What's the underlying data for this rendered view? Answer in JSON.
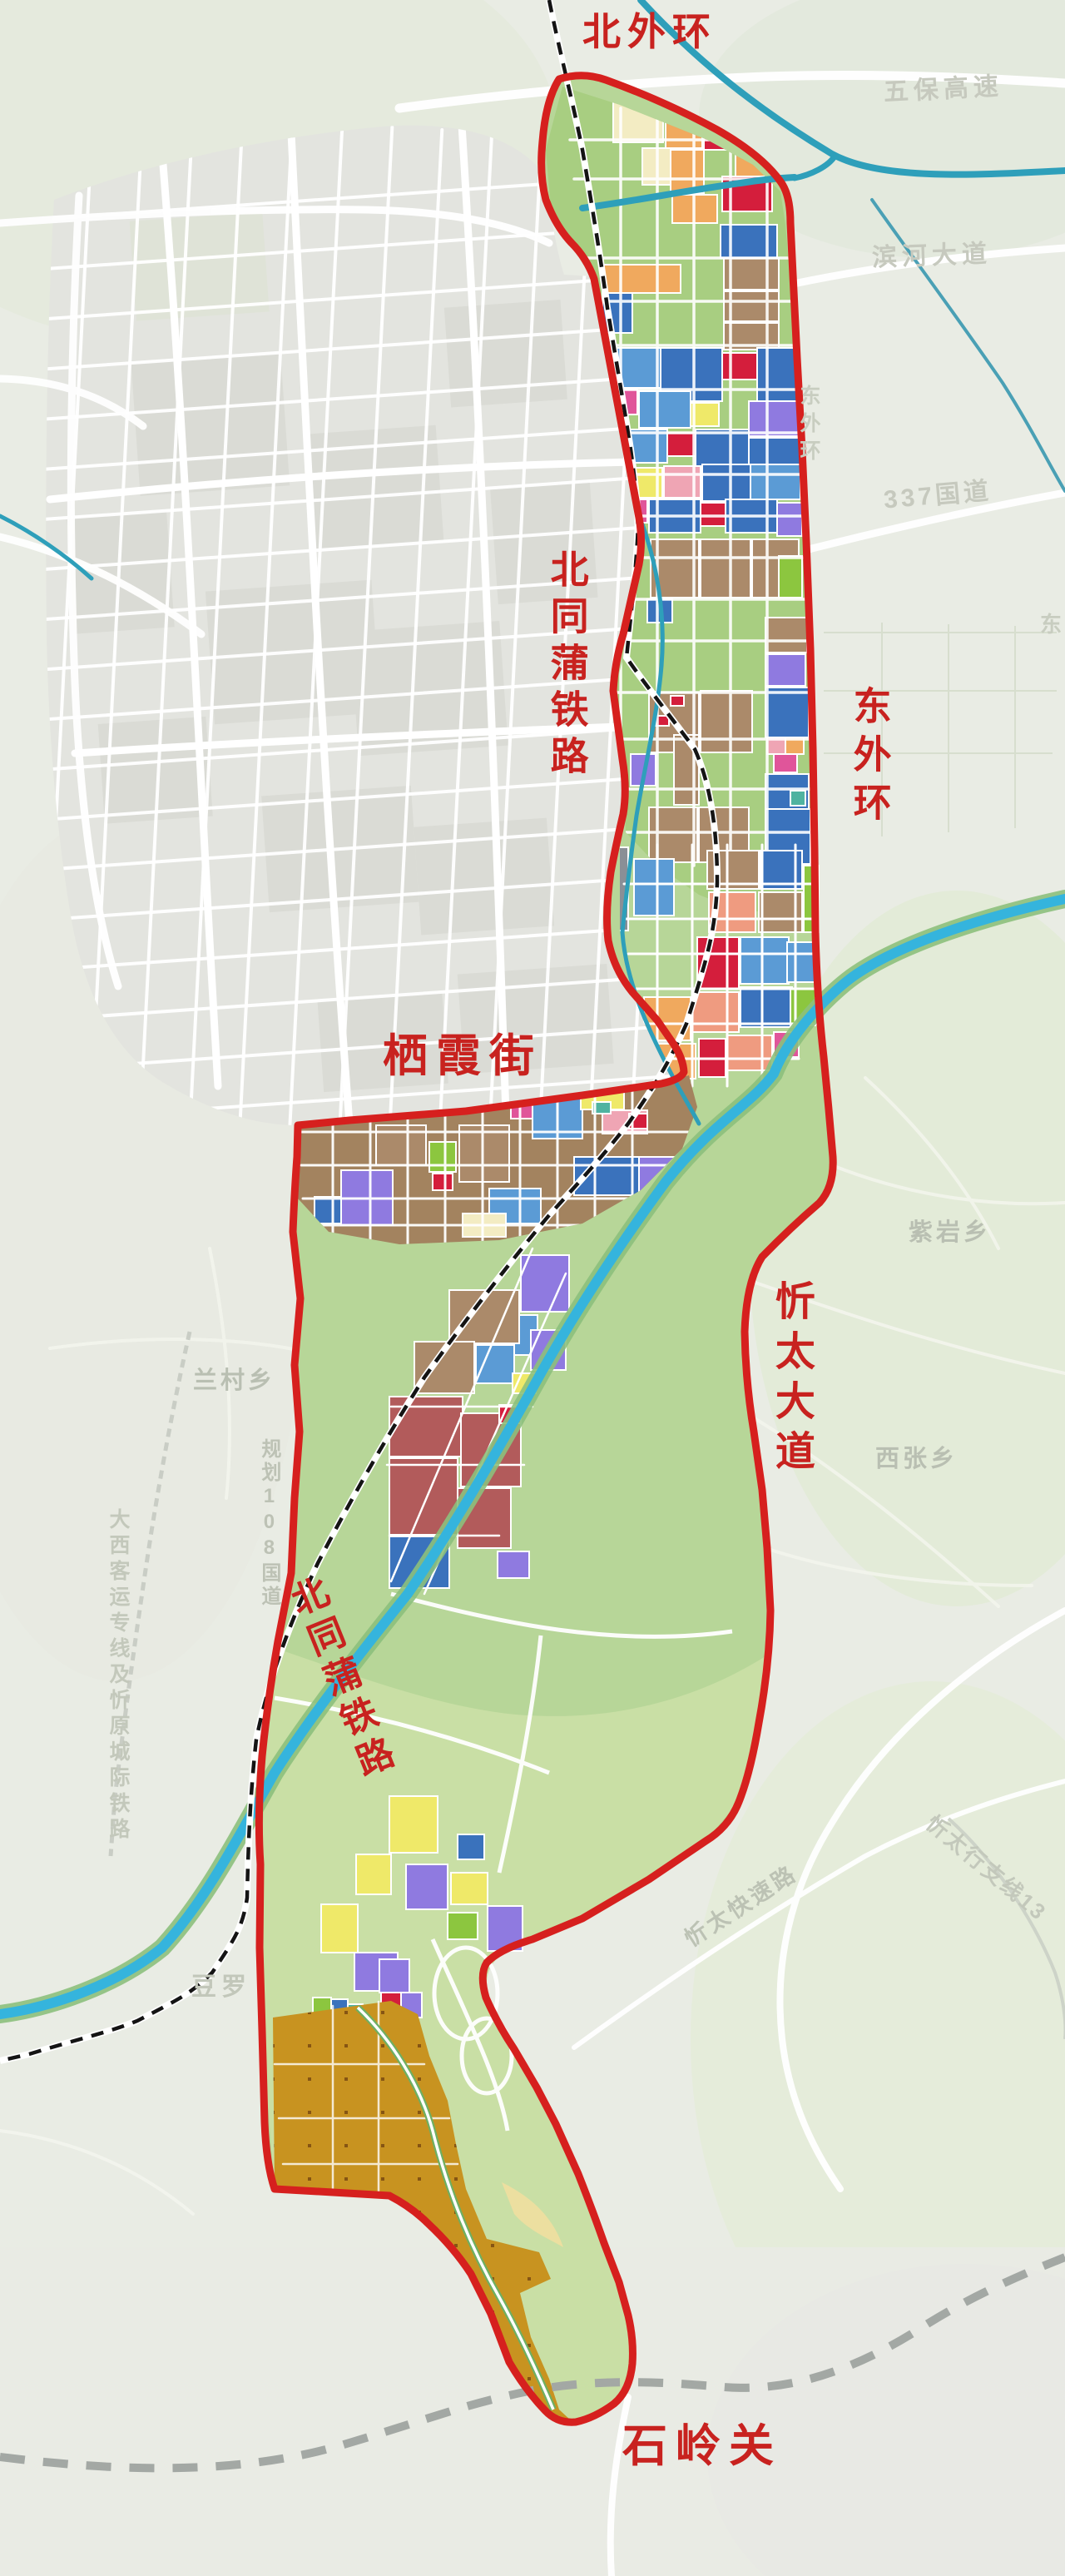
{
  "map": {
    "title": "urban-planning-map",
    "red_labels": {
      "north_outer_ring": "北外环",
      "beitongpu_railway_north": "北同蒲铁路",
      "east_outer_ring": "东外环",
      "qixia_street": "栖霞街",
      "xintai_avenue": "忻太大道",
      "beitongpu_railway_south": "北同蒲铁路",
      "shiling_pass": "石岭关"
    },
    "gray_labels": {
      "wubao_expressway": "五保高速",
      "binhe_avenue": "滨河大道",
      "national_road_337": "337国道",
      "east_partial": "东",
      "east_outer_ring_faint": "东外环",
      "ziyan_township": "紫岩乡",
      "xizhang_township": "西张乡",
      "lancun_township": "兰村乡",
      "planned_g108": "规划108国道",
      "daxi_rail_line": "大西客运专线及忻原城际铁路",
      "douluo": "豆罗",
      "xintai_expressway": "忻太快速路",
      "xintai_branch_13": "忻太行支线13"
    },
    "palette": {
      "boundary_red": "#d6201e",
      "label_red": "#c8221f",
      "river_blue": "#35b4dd",
      "stream_teal": "#2e9fba",
      "railway_black": "#141414",
      "admin_dash_gray": "#a3a8a4",
      "area_green": "#b7d698",
      "district_green": "#a8ce81",
      "south_green": "#c9dfa5",
      "orchard_ochre": "#c89320",
      "city_gray": "#e3e4df",
      "parcel_brown": "#ab8a6a",
      "parcel_orange": "#f0a95e",
      "parcel_red": "#d41e3c",
      "parcel_blue": "#3a72bc",
      "parcel_purple": "#8f7ae0",
      "parcel_yellow": "#efe969"
    }
  }
}
